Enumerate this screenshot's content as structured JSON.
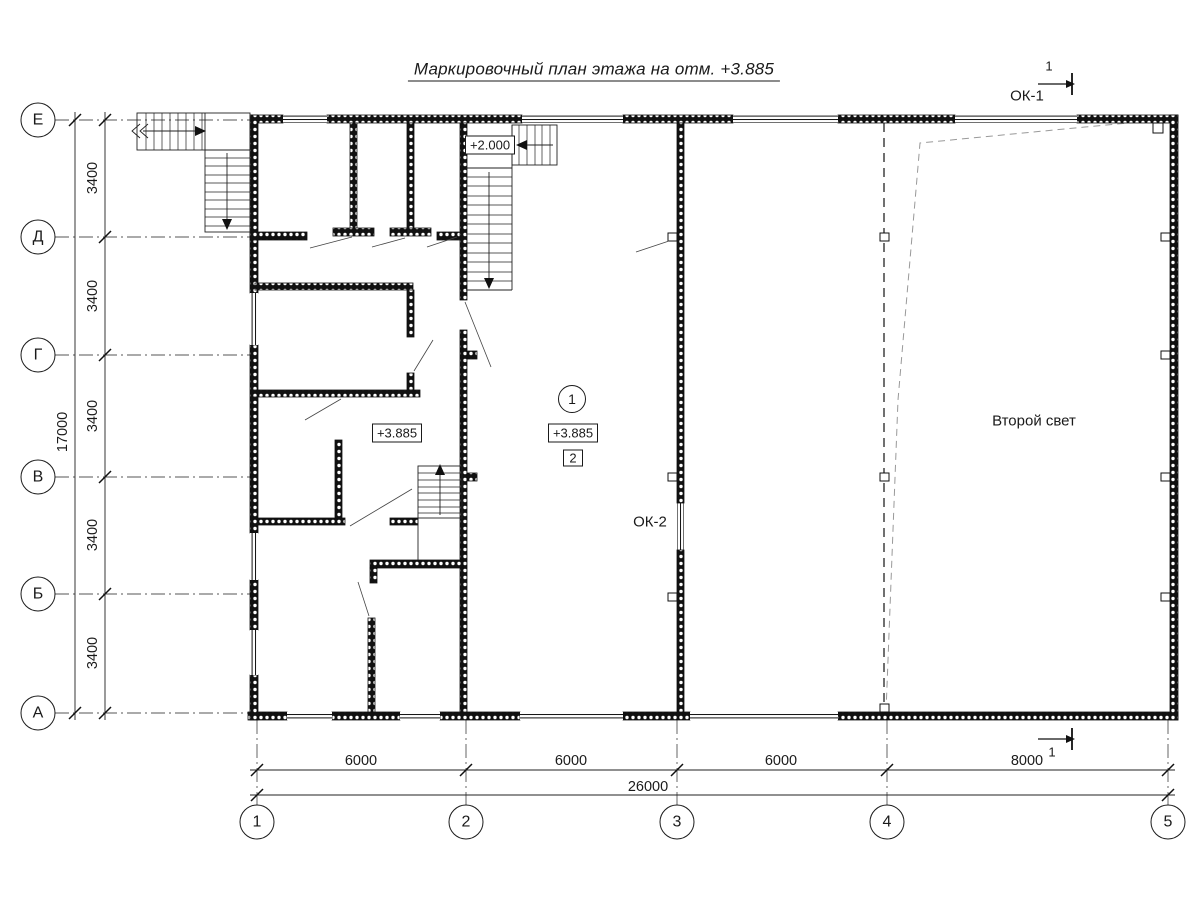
{
  "title": "Маркировочный план этажа на отм. +3.885",
  "axes": {
    "rows": [
      "Е",
      "Д",
      "Г",
      "В",
      "Б",
      "А"
    ],
    "cols": [
      "1",
      "2",
      "3",
      "4",
      "5"
    ]
  },
  "dims": {
    "left_total": "17000",
    "left_segments": [
      "3400",
      "3400",
      "3400",
      "3400",
      "3400"
    ],
    "bottom_segments": [
      "6000",
      "6000",
      "6000",
      "8000"
    ],
    "bottom_total": "26000"
  },
  "marks": {
    "ok1": "ОК-1",
    "ok2": "ОК-2",
    "elev_landing": "+2.000",
    "elev_left": "+3.885",
    "elev_center": "+3.885",
    "room_circle": "1",
    "room_square": "2",
    "void_label": "Второй свет",
    "section_top": "1",
    "section_bottom": "1"
  },
  "colors": {
    "ink": "#1a1a1a",
    "grid": "#555555",
    "axis_dash": "#333333",
    "void_dash": "#999999",
    "paper": "#ffffff"
  }
}
